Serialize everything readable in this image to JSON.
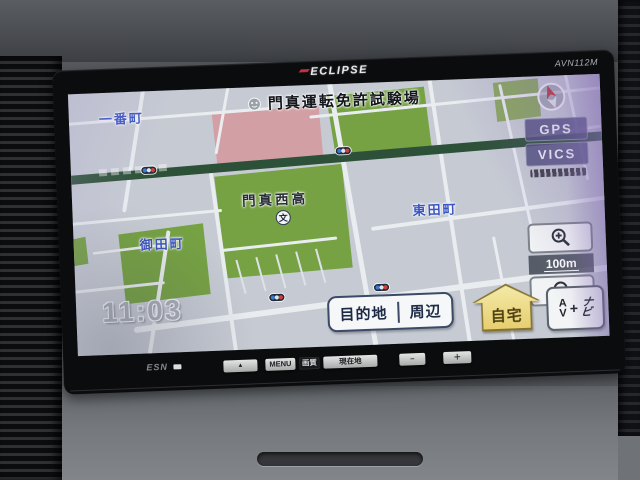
{
  "device": {
    "brand": "ECLIPSE",
    "model": "AVN112M",
    "unit_logo": "ESN"
  },
  "screen": {
    "header": {
      "facility_name": "門真運転免許試験場"
    },
    "status": {
      "gps": "GPS",
      "vics": "VICS"
    },
    "map": {
      "town_labels": {
        "ichibancho": "一番町",
        "higashidacho": "東田町",
        "ondacho": "御田町"
      },
      "poi": {
        "school_name": "門真西高",
        "school_symbol": "文"
      },
      "scale": "100m",
      "clock": "11:03"
    },
    "soft_buttons": {
      "destination": "目的地",
      "vicinity": "周辺",
      "home": "自宅",
      "av_a": "A",
      "av_v": "V",
      "av_plus": "+",
      "navi_na": "ナ",
      "navi_bi": "ビ"
    }
  },
  "hard_buttons": {
    "eject": "▲",
    "menu": "MENU",
    "picture_quality": "画質",
    "current_location": "現在地",
    "minus": "−",
    "plus": "＋"
  },
  "colors": {
    "map_background": "#c6cbd3",
    "map_green": "#76a243",
    "map_pink": "#d2a0a4",
    "major_road_green": "#2d5138",
    "town_label_blue": "#3a54c0",
    "home_button_yellow": "#e6cf70",
    "gps_vics_purple": "#4e4e7a",
    "hard_button_silver": "#c9ccc9"
  }
}
